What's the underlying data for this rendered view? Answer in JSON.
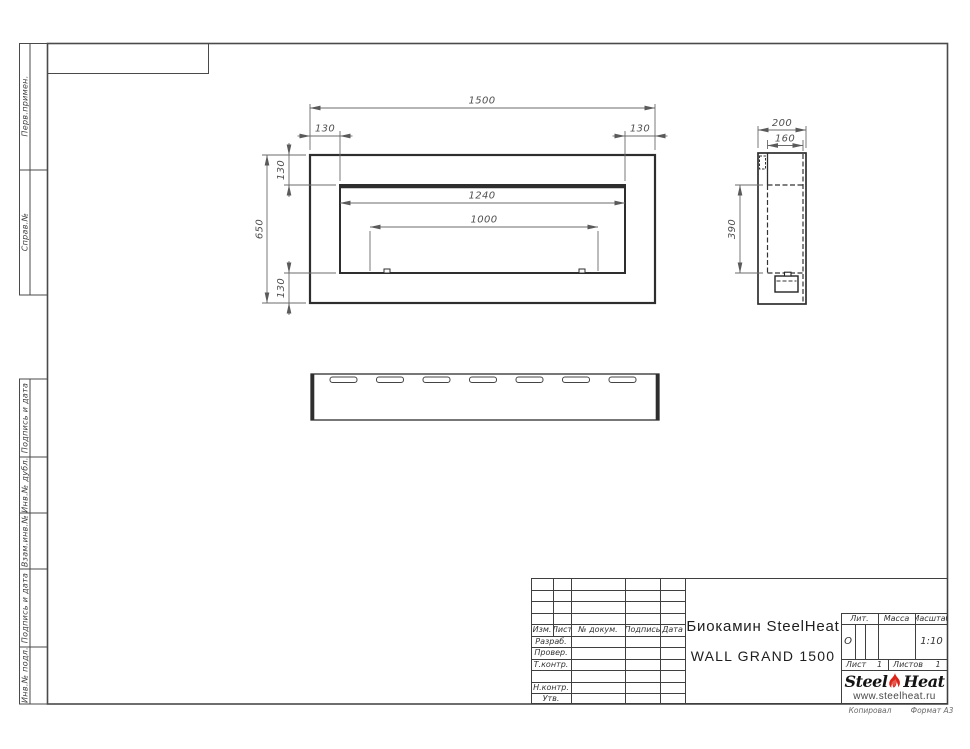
{
  "document": {
    "type_note": "engineering drawing, GOST title block",
    "product_title_line1": "Биокамин SteelHeat",
    "product_title_line2": "WALL GRAND 1500"
  },
  "colors": {
    "object_line": "#2e2e2e",
    "dimension_line": "#6b6b6b",
    "frame_line": "#4a4a4a",
    "flame_red": "#dc2418"
  },
  "views": {
    "front": {
      "dim_total_width": "1500",
      "dim_flange_left": "130",
      "dim_flange_right": "130",
      "dim_total_height": "650",
      "dim_flange_top": "130",
      "dim_flange_bottom": "130",
      "dim_opening_width": "1240",
      "dim_burner_length": "1000"
    },
    "side": {
      "dim_depth": "200",
      "dim_body_depth": "160",
      "dim_opening_height": "390"
    },
    "top": {
      "slot_count": 7
    }
  },
  "stamps": {
    "top": [
      "Перв.примен.",
      "Справ.№"
    ],
    "bottom": [
      "Подпись и дата",
      "Инв.№ дубл.",
      "Взам.инв.№",
      "Подпись и дата",
      "Инв.№ подл."
    ]
  },
  "title_block": {
    "header_cols": [
      "Изм.",
      "Лист",
      "№ докум.",
      "Подпись",
      "Дата"
    ],
    "signature_rows": [
      "Разраб.",
      "Провер.",
      "Т.контр.",
      "",
      "Н.контр.",
      "Утв."
    ],
    "lit_label": "Лит.",
    "lit_value": "О",
    "mass_label": "Масса",
    "scale_label": "Масштаб",
    "scale_value": "1:10",
    "sheet_label": "Лист",
    "sheet_value": "1",
    "sheets_label": "Листов",
    "sheets_value": "1"
  },
  "logo": {
    "steel": "Steel",
    "heat": "Heat",
    "url": "www.steelheat.ru"
  },
  "footer": {
    "copy_label": "Копировал",
    "format_label": "Формат А3"
  }
}
